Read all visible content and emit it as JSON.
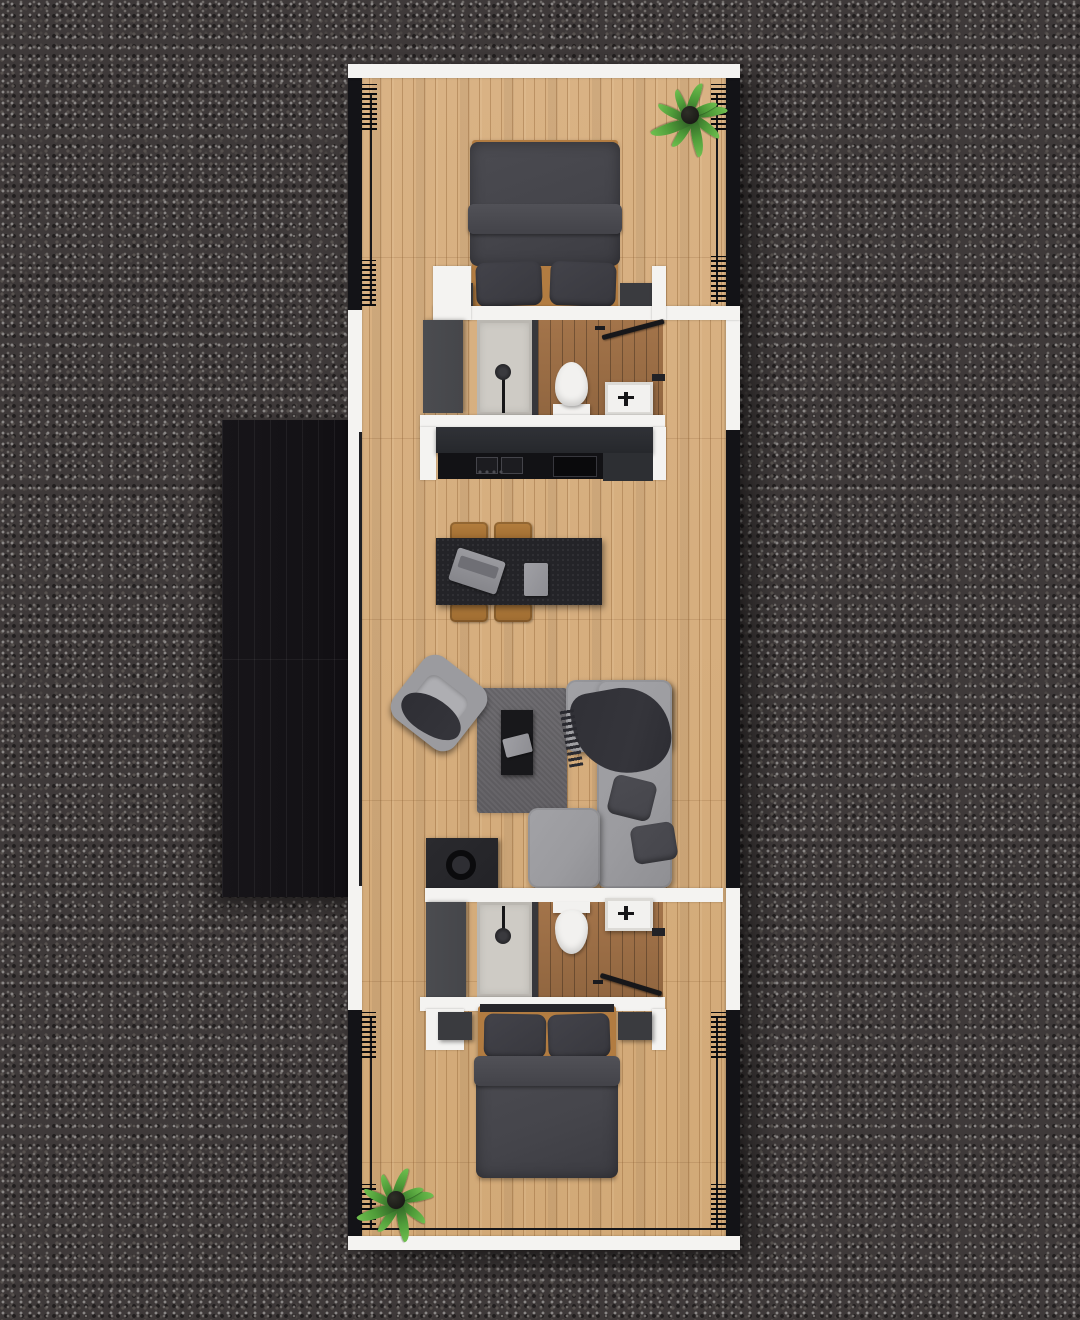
{
  "scene": {
    "title": "Top-down 3D render floor plan of a rectangular tiny home on a dark gravel pad",
    "environment": "dark gravel / asphalt ground",
    "building": "single elongated module, white end and partition walls, black glazed long walls, oak plank flooring",
    "deck": "charred black timber deck attached to the left side"
  },
  "rooms": {
    "bedroom_north": {
      "label": "Bedroom (top)",
      "items": [
        "double bed with dark duvet",
        "two dark pillows",
        "oak bed frame",
        "nightstand left",
        "nightstand right",
        "potted plant",
        "curtain bundles on glazing"
      ]
    },
    "bathroom_north": {
      "label": "Bathroom (upper)",
      "items": [
        "wardrobe",
        "walk-in shower",
        "toilet",
        "vanity sink",
        "door ajar"
      ]
    },
    "kitchen": {
      "label": "Kitchen",
      "items": [
        "counter run",
        "two-zone cooktop",
        "control knobs",
        "basin sink",
        "appliance block"
      ]
    },
    "dining": {
      "label": "Dining",
      "items": [
        "black island table",
        "four oak chairs",
        "laptop",
        "book"
      ]
    },
    "living": {
      "label": "Living room",
      "items": [
        "swivel armchair with throw",
        "gray area rug",
        "black coffee table",
        "book",
        "L-shaped sofa",
        "dark throw blanket",
        "two cushions",
        "speaker cabinet"
      ]
    },
    "bathroom_south": {
      "label": "Bathroom (lower)",
      "items": [
        "wardrobe",
        "walk-in shower",
        "toilet",
        "vanity sink",
        "door ajar"
      ]
    },
    "bedroom_south": {
      "label": "Bedroom (bottom)",
      "items": [
        "double bed with dark duvet",
        "two dark pillows",
        "oak bed frame",
        "nightstand left",
        "nightstand right",
        "potted plant",
        "curtain rail"
      ]
    },
    "deck": {
      "label": "Side deck",
      "items": [
        "black deck boards"
      ]
    }
  },
  "palette": {
    "gravel-base": "#3e3939",
    "gravel-speck-light": "#8a8786",
    "gravel-speck-dark": "#211e1e",
    "wall-white": "#f4f3f1",
    "glazing-black": "#131317",
    "wood-base": "#d9b284",
    "wet-wood": "#a3744a",
    "deck-black": "#171519",
    "duvet-gray": "#45454b",
    "pillow-gray": "#38383e",
    "frame-wood": "#b27c41",
    "nightstand-gray": "#3a3b3f",
    "sofa-gray": "#9b9b9f",
    "throw-gray": "#35353b",
    "cushion-gray": "#45454b",
    "rug-gray": "#6f6d71",
    "coffee-table": "#18181b",
    "book-gray": "#8d8d92",
    "table-black": "#242428",
    "chair-wood": "#b57f3e",
    "counter-upper": "#303237",
    "counter-dark": "#121215",
    "counter-right": "#2d2f33",
    "shower-tray": "#cecbc5",
    "porcelain": "#f2f1ef",
    "fixture-dark": "#161618",
    "wardrobe-gray": "#45464a",
    "rail-black": "#17171a",
    "speaker-black": "#232327",
    "leaf-dark": "#2c5a23",
    "leaf-mid": "#4f9c39",
    "leaf-light": "#6fbf4f"
  }
}
